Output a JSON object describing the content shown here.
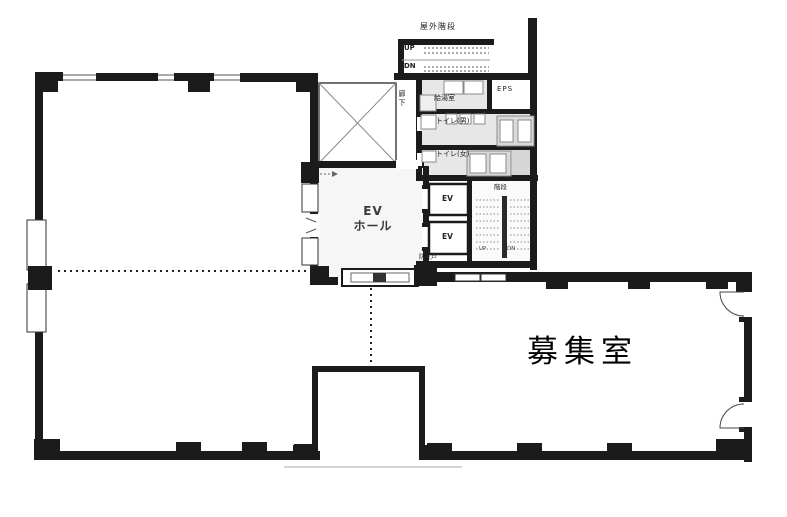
{
  "floorplan": {
    "labels": {
      "outdoor_stairs": "屋外階段",
      "up": "UP",
      "down": "DN",
      "corridor": "廊下",
      "kitchenette": "給湯室",
      "eps": "EPS",
      "toilet_men": "トイレ(男)",
      "toilet_women": "トイレ(女)",
      "inner_stairs": "階段",
      "inner_up": "UP",
      "inner_down": "DN",
      "elevator": "EV",
      "ev_hall_line1": "EV",
      "ev_hall_line2": "ホール",
      "fire_door": "防火戸",
      "vacant_room": "募集室"
    },
    "colors": {
      "wall": "#1b1b1b",
      "wet_area": "#e7e7e7",
      "stall": "#d9d9d9",
      "background": "#ffffff",
      "text": "#222222"
    }
  }
}
